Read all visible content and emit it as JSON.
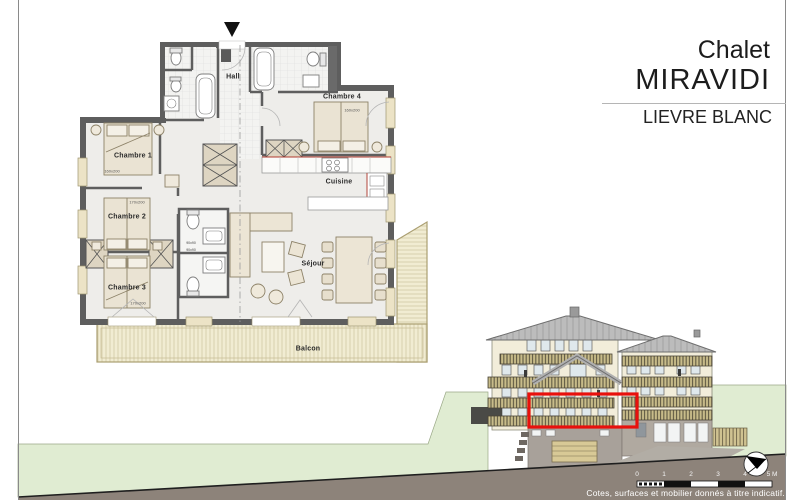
{
  "title_block": {
    "line1": "Chalet",
    "line2": "MIRAVIDI",
    "project": "LIEVRE BLANC"
  },
  "floor_plan": {
    "labels": {
      "hall": "Hall",
      "chambre1": "Chambre 1",
      "chambre1_dim": "160x200",
      "chambre2": "Chambre 2",
      "chambre2_dim": "170x200",
      "chambre3": "Chambre 3",
      "chambre3_dim": "170x200",
      "chambre4": "Chambre 4",
      "chambre4_dim": "160x200",
      "cuisine": "Cuisine",
      "sejour": "Séjour",
      "balcon": "Balcon",
      "shower1": "90x90",
      "shower2": "90x90"
    }
  },
  "elevation": {
    "highlight_color": "#e8100c"
  },
  "scale_bar": {
    "unit_ticks": [
      "0",
      "1",
      "2",
      "3",
      "4",
      "5 M"
    ]
  },
  "footer": {
    "disclaimer": "Cotes, surfaces et mobilier donnés à titre indicatif."
  },
  "icons": {
    "north_arrow": "compass-north-icon",
    "entrance_marker": "entrance-arrow-icon"
  },
  "colors": {
    "wall": "#5e5e5e",
    "facade_cream": "#f2edda",
    "roof_gray": "#b9b9b9",
    "balcony_wood": "#f1ecd2",
    "terrain_green": "#e0ecd2",
    "ground_brown": "#8d837a",
    "accent_red": "#e8100c"
  }
}
